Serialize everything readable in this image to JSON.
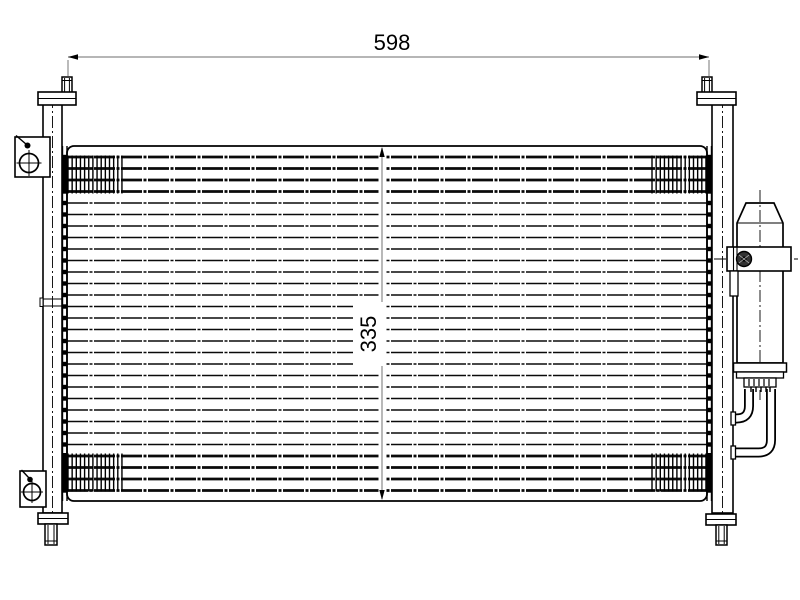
{
  "title": "condenser-technical-drawing",
  "dimensions": {
    "width": {
      "label": "598"
    },
    "height": {
      "label": "335"
    }
  },
  "colors": {
    "line": "#000000",
    "dim_line": "#8a8a8a",
    "background": "#ffffff"
  },
  "parts": {
    "core": "tube-and-fin-core",
    "left_tank": "left-header-tank",
    "right_tank": "right-header-tank",
    "drier": "receiver-drier",
    "bracket_top": "mounting-bracket-top-left",
    "bracket_bottom": "mounting-bracket-bottom-left",
    "pipes": "drier-connecting-pipes"
  },
  "generator": {
    "tubes": {
      "count": 30,
      "y0": 157,
      "pitch": 11.5,
      "x1": 67,
      "x2": 707,
      "thickTop": 4,
      "thickBottom": 4,
      "dash": "21 1.5 3 1.5",
      "thickW": 2.8,
      "thinW": 1.5
    },
    "nubs": {
      "h": 4.4,
      "leftX": 55.5,
      "rightX": 707.5,
      "w": 11
    },
    "hatch": {
      "cols": [
        68,
        652
      ],
      "rows": [
        155.5,
        453.5
      ],
      "w": 54,
      "h": 38,
      "step": 4.15,
      "lineW": 1.4
    },
    "blocks": [
      [
        57.5,
        155,
        10,
        38.5
      ],
      [
        706.5,
        155,
        10,
        38.5
      ],
      [
        57.5,
        453,
        10,
        38.5
      ],
      [
        706.5,
        453,
        10,
        38.5
      ]
    ]
  }
}
